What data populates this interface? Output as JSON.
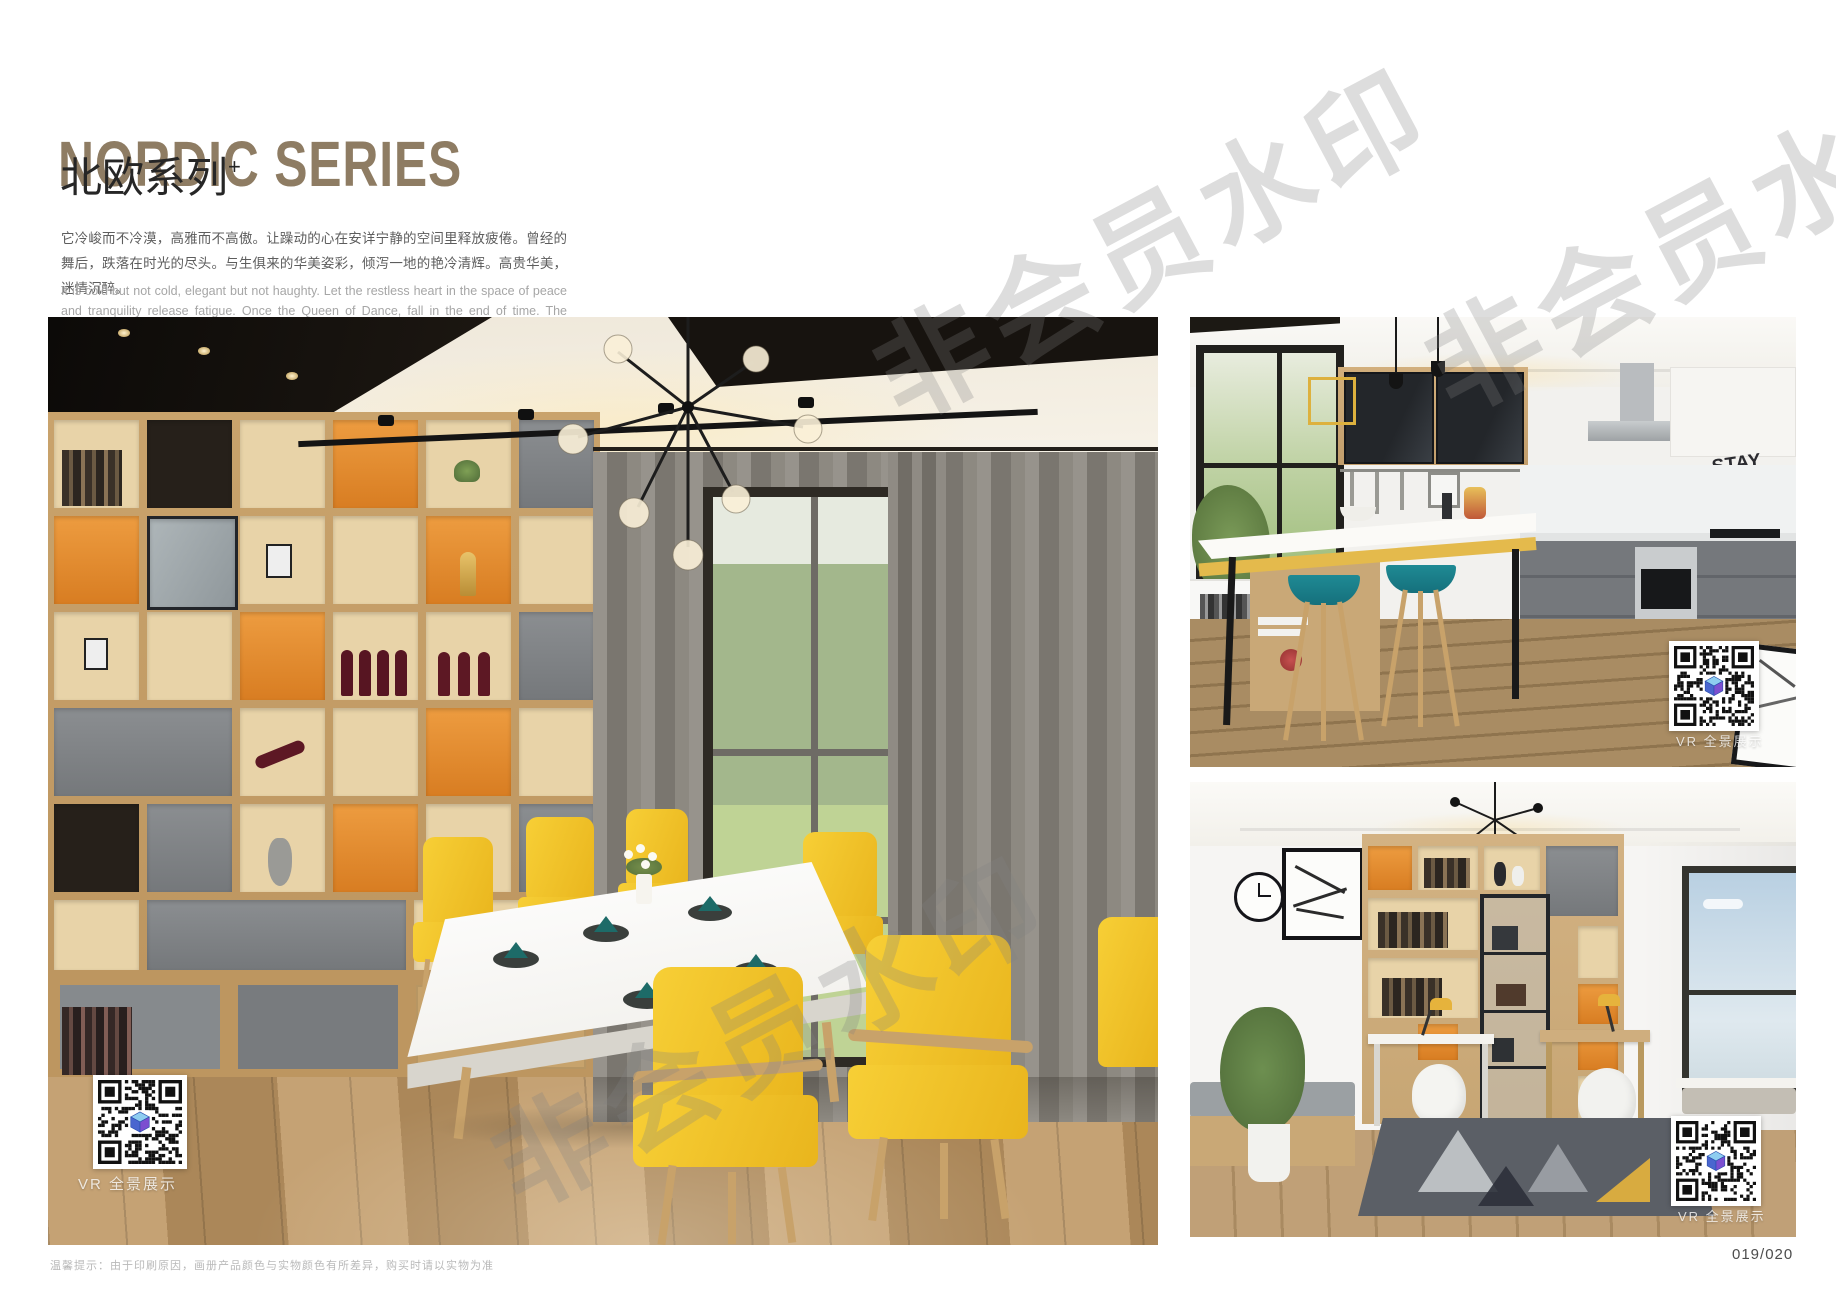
{
  "header": {
    "title_en": "NORDIC SERIES",
    "title_cn": "北欧系列",
    "title_sup": "+",
    "desc_cn": "它冷峻而不冷漠，高雅而不高傲。让躁动的心在安详宁静的空间里释放疲倦。曾经的舞后，跌落在时光的尽头。与生俱来的华美姿彩，倾泻一地的艳冷清辉。高贵华美，迷情沉醉。",
    "desc_en": "It is cold but not cold, elegant but not haughty. Let the restless heart in the space of peace and tranquility release fatigue. Once the Queen of Dance, fall in the end of time. The natural beauty of the beautiful, pouring a land of cold and pure brilliance. Noble, beautiful, enchanted."
  },
  "photos": {
    "dining": {
      "vr_label": "VR 全景展示"
    },
    "kitchen": {
      "vr_label": "VR 全景展示",
      "wall_text": [
        "STAY",
        "TRUE",
        "STAY",
        "YOU"
      ]
    },
    "study": {
      "vr_label": "VR 全景展示"
    }
  },
  "watermark": {
    "text": "非会员水印"
  },
  "footer": {
    "note": "温馨提示：由于印刷原因，画册产品颜色与实物颜色有所差异，购买时请以实物为准",
    "page_number": "019/020"
  },
  "colors": {
    "title_bronze": "#8e7c63",
    "accent_orange": "#e08a2e",
    "chair_yellow": "#f2c52a",
    "stool_teal": "#1b7f8c",
    "wood": "#c9a26a",
    "qr_cube_blue": "#4a66cf"
  }
}
